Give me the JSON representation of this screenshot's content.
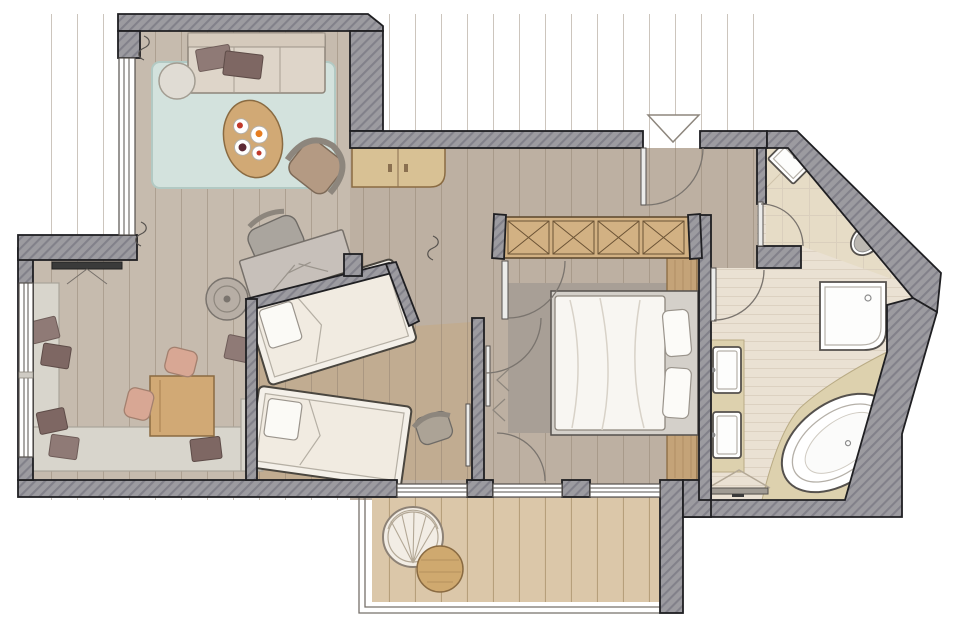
{
  "colors": {
    "wall-fill": "#9c9ba0",
    "wall-hatch": "#82818a",
    "wall-stroke": "#1f1f22",
    "floor-living": "#c6bbae",
    "floor-hall": "#bdb0a2",
    "floor-kids": "#c1ac91",
    "plank-line": "#8d7d6b",
    "rug-mint": "#d3e2dd",
    "rug-border": "#b2c9c3",
    "rug-gray": "#a89f96",
    "tile-bath": "#eae1d3",
    "tile-line": "#d9cdbd",
    "tile-wc": "#e6dcc6",
    "marble": "#ddd1ae",
    "deck": "#dbc7a9",
    "deck-line": "#a28a62",
    "white": "#ffffff",
    "outline": "#55514d",
    "wood-furniture": "#d1a975",
    "wood-dark": "#8a6b42",
    "sideboard": "#d8c194",
    "sofa": "#ded5c9",
    "sofa-back": "#d5cabc",
    "cushion-dark": "#7e6763",
    "cushion-light": "#8f7a76",
    "bench": "#d8d5cc",
    "salmon": "#d8a794",
    "gray-furniture": "#aaa59e",
    "tan-chair": "#b49a83",
    "bed-linen": "#f8f6f2",
    "bed-frame": "#d4d0ca",
    "mattress": "#f1ebe1",
    "wardrobe-wood": "#d2b183",
    "wardrobe-line": "#5b452b",
    "headboard": "#c4a378",
    "metal": "#8c8c8c",
    "arc": "#7a746e",
    "pouf": "#e0dcd4",
    "desk": "#c7c0ba",
    "food-red": "#c0392b",
    "food-orange": "#e67e22",
    "food-plum": "#5d2a35"
  },
  "rooms": [
    {
      "id": "living-area"
    },
    {
      "id": "study-lounge"
    },
    {
      "id": "kids-bedroom"
    },
    {
      "id": "master-bedroom"
    },
    {
      "id": "hallway"
    },
    {
      "id": "bathroom"
    },
    {
      "id": "wc"
    },
    {
      "id": "balcony"
    }
  ],
  "furniture": [
    {
      "id": "sofa",
      "room": "living-area"
    },
    {
      "id": "pouf",
      "room": "living-area"
    },
    {
      "id": "coffee-table",
      "room": "living-area"
    },
    {
      "id": "armchair",
      "room": "living-area"
    },
    {
      "id": "area-rug",
      "room": "living-area"
    },
    {
      "id": "sideboard",
      "room": "living-area"
    },
    {
      "id": "wall-tv",
      "room": "study-lounge"
    },
    {
      "id": "corner-bench",
      "room": "study-lounge"
    },
    {
      "id": "cushions",
      "room": "study-lounge"
    },
    {
      "id": "table",
      "room": "study-lounge"
    },
    {
      "id": "two-chairs",
      "room": "study-lounge"
    },
    {
      "id": "round-side-table",
      "room": "study-lounge"
    },
    {
      "id": "desk",
      "room": "study-lounge"
    },
    {
      "id": "desk-chair",
      "room": "study-lounge"
    },
    {
      "id": "single-bed-1",
      "room": "kids-bedroom"
    },
    {
      "id": "single-bed-2",
      "room": "kids-bedroom"
    },
    {
      "id": "small-armchair",
      "room": "kids-bedroom"
    },
    {
      "id": "double-bed",
      "room": "master-bedroom"
    },
    {
      "id": "headboard-panel",
      "room": "master-bedroom"
    },
    {
      "id": "wardrobe",
      "room": "master-bedroom"
    },
    {
      "id": "gray-rug",
      "room": "master-bedroom"
    },
    {
      "id": "double-vanity",
      "room": "bathroom"
    },
    {
      "id": "corner-shower",
      "room": "bathroom"
    },
    {
      "id": "oval-bathtub",
      "room": "bathroom"
    },
    {
      "id": "towel-rail",
      "room": "bathroom"
    },
    {
      "id": "toilet",
      "room": "wc"
    },
    {
      "id": "corner-sink",
      "room": "wc"
    },
    {
      "id": "hanging-chair",
      "room": "balcony"
    },
    {
      "id": "side-table",
      "room": "balcony"
    }
  ],
  "openings": [
    {
      "id": "entrance-door"
    },
    {
      "id": "master-bedroom-door"
    },
    {
      "id": "kids-room-door"
    },
    {
      "id": "bathroom-door"
    },
    {
      "id": "wc-door"
    },
    {
      "id": "balcony-sliding-doors"
    },
    {
      "id": "living-room-window"
    },
    {
      "id": "study-window"
    }
  ]
}
